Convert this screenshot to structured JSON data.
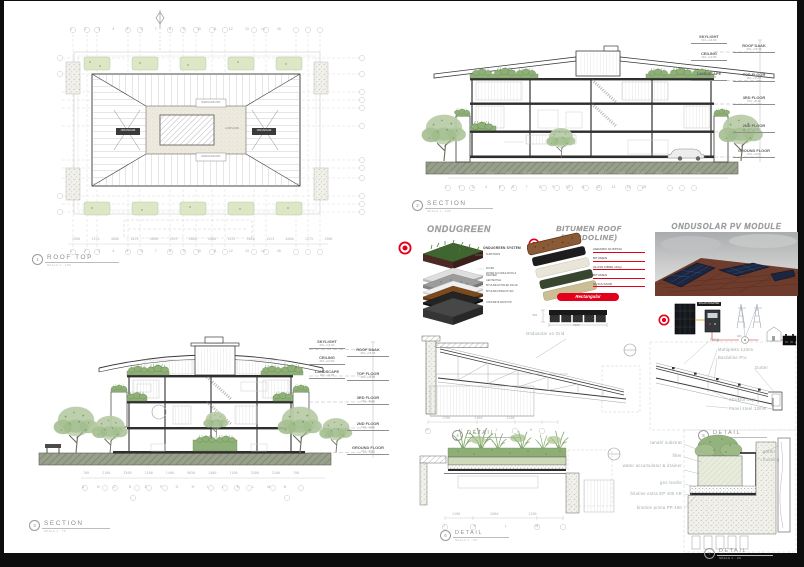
{
  "roof_plan": {
    "num": "1",
    "title": "ROOF TOP",
    "scale": "SKALA 1 : 100",
    "grid_numbers": "1 2 3 4 5 6 7 8 9 10 11 12 13 14 15",
    "dims": "1900 1375 4000 1525 4000 1525 2800 2800 1525 4000 1525 4000 1375 1900",
    "label_left_chip": "ONDUSOLAR",
    "label_right_chip": "ONDUSOLAR",
    "label_top_box": "BARDOLINE PRO",
    "label_bottom_box": "BARDOLINE PRO",
    "label_court": "LANDSCAPE"
  },
  "levels": {
    "skylight": {
      "name": "SKYLIGHT",
      "ffl": "FFL +14.90"
    },
    "ceiling": {
      "name": "CEILING",
      "ffl": "FFL +13.80"
    },
    "landscape": {
      "name": "LANDSCAPE",
      "ffl": "FFL +11.95"
    },
    "roof_daak": {
      "name": "ROOF DAAK",
      "ffl": "FFL +15.35"
    },
    "top_floor": {
      "name": "TOP FLOOR",
      "ffl": "FFL +11.95"
    },
    "third_floor": {
      "name": "3RD FLOOR",
      "ffl": "FFL +8.40"
    },
    "second_floor": {
      "name": "2ND FLOOR",
      "ffl": "FFL +4.90"
    },
    "ground_floor": {
      "name": "GROUND FLOOR",
      "ffl": "FFL +0.00"
    }
  },
  "section_top": {
    "num": "2",
    "title": "SECTION",
    "scale": "SKALA 1 : 100",
    "dims": "1900 1375 4000 1525 4000 1525 2800 2800 1525 4000 1525 4000 1375 1900",
    "grid_numbers": "1 2 3 4 5 6 7 8 9 10 11 12 13 14 15"
  },
  "section_bottom": {
    "num": "3",
    "title": "SECTION",
    "scale": "SKALA 1 : 75",
    "dims": "700 2100 3300 1100 1400 9850 1400 1100 3300 2100 700",
    "grid_letters": "A B C D E F G H I J K L M N"
  },
  "ondugreen": {
    "title": "ONDUGREEN",
    "system_title": "ONDUGREEN SYSTEM",
    "layers": [
      "SUBSTRATE",
      "FILTER",
      "WATER ACCUMULATION & DRAINER",
      "GEOTEXTILE",
      "BITULINE EXTRA EP 400 AR",
      "BITULINE PRIMA PP 400",
      "CONCRETE ROOFTOP"
    ]
  },
  "bardoline": {
    "title": "BITUMEN ROOF (BARDOLINE)",
    "layers": [
      "CERAMIC DUSTING",
      "BITUMEN",
      "GLASS FIBRE 110gr",
      "BITUMEN",
      "SILICA SAND"
    ],
    "button": "Rectangular",
    "dim_height": "340",
    "dim_width": "1000"
  },
  "ondusolar": {
    "title": "ONDUSOLAR PV MODULE",
    "inverter_label": "SOLAR INVERTER",
    "meter_label": "kWh"
  },
  "detail_a": {
    "num": "4",
    "title": "DETAIL",
    "scale": "SKALA 1 : 50",
    "note": "Ondusolar on Grid",
    "dims": "1700 1400 1100",
    "grid_letters": "H I J K"
  },
  "detail_b": {
    "num": "5",
    "title": "DETAIL",
    "scale": "SKALA 1 : 20",
    "labels": [
      "reng",
      "Multipleks 12mm",
      "Bardoline Pro",
      "Gutter",
      "Struktur baja",
      "Panel steel 12mm"
    ]
  },
  "detail_c": {
    "num": "6",
    "title": "DETAIL",
    "scale": "SKALA 1 : 50",
    "dims": "1100 2000 1200",
    "grid_letters": "J K L M"
  },
  "detail_d": {
    "num": "7",
    "title": "DETAIL",
    "scale": "SKALA 1 : 20",
    "labels_left": [
      "tanah/ substrat",
      "filter",
      "water accumulator & drainer",
      "geo textile",
      "bituline extra EP 400 AR",
      "bituline prima PP 400"
    ],
    "labels_right": [
      "gutter",
      "flushing"
    ]
  }
}
